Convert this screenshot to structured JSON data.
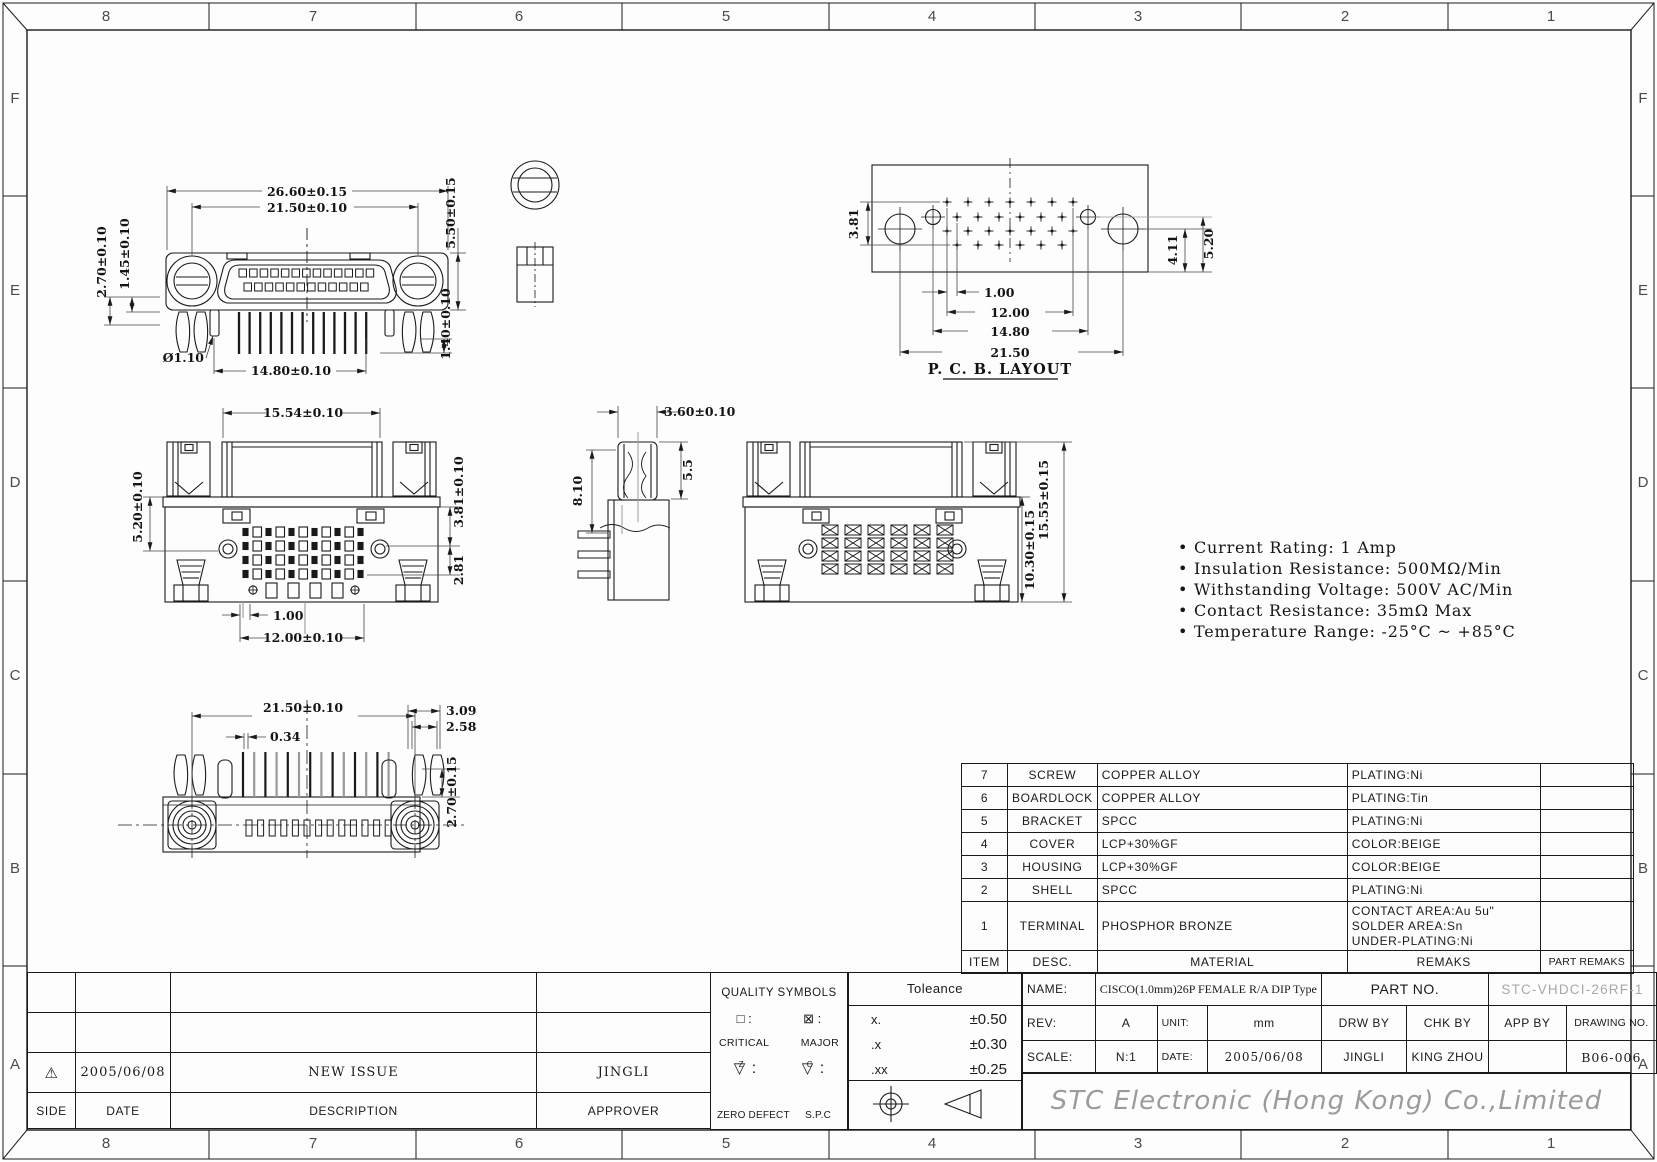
{
  "colors": {
    "ink": "#1a1a1a",
    "gray": "#9a9a9a",
    "part_no_gray": "#a8a8a8",
    "company_gray": "#9b9b9b"
  },
  "frame": {
    "cols": [
      "8",
      "7",
      "6",
      "5",
      "4",
      "3",
      "2",
      "1"
    ],
    "rows": [
      "F",
      "E",
      "D",
      "C",
      "B",
      "A"
    ]
  },
  "views": {
    "front": {
      "dim_width_outer": "26.60±0.15",
      "dim_width_inner": "21.50±0.10",
      "dim_tab": "5.50±0.15",
      "dim_left_outer": "2.70±0.10",
      "dim_left_inner": "1.45±0.10",
      "dim_pin_dia": "Ø1.10",
      "dim_pin_span": "14.80±0.10",
      "dim_pin_offset": "1.40±0.10"
    },
    "pcb": {
      "title": "P. C. B. LAYOUT",
      "dim_row": "3.81",
      "dim_pitch": "1.00",
      "dim_span1": "12.00",
      "dim_span2": "14.80",
      "dim_span3": "21.50",
      "dim_right1": "4.11",
      "dim_right2": "5.20"
    },
    "assembly_front": {
      "dim_top": "15.54±0.10",
      "dim_left": "5.20±0.10",
      "dim_right1": "3.81±0.10",
      "dim_right2": "2.81",
      "dim_pitch": "1.00",
      "dim_span": "12.00±0.10"
    },
    "side": {
      "dim_top": "3.60±0.10",
      "dim_left": "8.10",
      "dim_right": "5.5"
    },
    "assembly_rear": {
      "dim_right1": "10.30±0.15",
      "dim_right2": "15.55±0.15"
    },
    "bottom": {
      "dim_span": "21.50±0.10",
      "dim_pin": "0.34",
      "dim_r1": "3.09",
      "dim_r2": "2.58",
      "dim_height": "2.70±0.15"
    }
  },
  "notes": {
    "bullet": "•",
    "items": [
      "Current Rating: 1 Amp",
      "Insulation Resistance: 500MΩ/Min",
      "Withstanding Voltage: 500V AC/Min",
      "Contact Resistance: 35mΩ Max",
      "Temperature Range: -25°C ~ +85°C"
    ]
  },
  "parts_table": {
    "headers": {
      "item": "ITEM",
      "desc": "DESC.",
      "material": "MATERIAL",
      "remarks": "REMAKS",
      "part_remarks": "PART REMAKS"
    },
    "rows": [
      {
        "item": "7",
        "desc": "SCREW",
        "material": "COPPER ALLOY",
        "remarks": "PLATING:Ni"
      },
      {
        "item": "6",
        "desc": "BOARDLOCK",
        "material": "COPPER ALLOY",
        "remarks": "PLATING:Tin"
      },
      {
        "item": "5",
        "desc": "BRACKET",
        "material": "SPCC",
        "remarks": "PLATING:Ni"
      },
      {
        "item": "4",
        "desc": "COVER",
        "material": "LCP+30%GF",
        "remarks": "COLOR:BEIGE"
      },
      {
        "item": "3",
        "desc": "HOUSING",
        "material": "LCP+30%GF",
        "remarks": "COLOR:BEIGE"
      },
      {
        "item": "2",
        "desc": "SHELL",
        "material": "SPCC",
        "remarks": "PLATING:Ni"
      },
      {
        "item": "1",
        "desc": "TERMINAL",
        "material": "PHOSPHOR BRONZE",
        "remarks_lines": [
          "CONTACT AREA:Au 5u\"",
          "SOLDER AREA:Sn",
          "UNDER-PLATING:Ni"
        ]
      }
    ]
  },
  "revision": {
    "headers": {
      "side": "SIDE",
      "date": "DATE",
      "description": "DESCRIPTION",
      "approver": "APPROVER"
    },
    "entry": {
      "symbol": "⚠",
      "date": "2005/06/08",
      "description": "NEW ISSUE",
      "approver": "JINGLI"
    }
  },
  "quality": {
    "title": "QUALITY SYMBOLS",
    "critical_symbol": "□",
    "major_symbol": "⊠",
    "colon": ":",
    "finish_symbol": "▽",
    "zero_defect_letter": "Z",
    "spc_letter": "C",
    "critical_label": "CRITICAL",
    "major_label": "MAJOR",
    "zero_defect_label": "ZERO DEFECT",
    "spc_label": "S.P.C"
  },
  "tolerance": {
    "title": "Toleance",
    "rows": [
      {
        "label": "x.",
        "value": "±0.50"
      },
      {
        "label": ".x",
        "value": "±0.30"
      },
      {
        "label": ".xx",
        "value": "±0.25"
      }
    ]
  },
  "title_block": {
    "name_label": "NAME:",
    "name_value": "CISCO(1.0mm)26P FEMALE R/A DIP Type",
    "part_no_label": "PART NO.",
    "part_no_value": "STC-VHDCI-26RF-1",
    "rev_label": "REV:",
    "rev_value": "A",
    "unit_label": "UNIT:",
    "unit_value": "mm",
    "drw_by_label": "DRW BY",
    "drw_by_value": "JINGLI",
    "chk_by_label": "CHK BY",
    "chk_by_value": "KING ZHOU",
    "app_by_label": "APP BY",
    "app_by_value": "",
    "drawing_no_label": "DRAWING NO.",
    "drawing_no_value": "B06-006",
    "scale_label": "SCALE:",
    "scale_value": "N:1",
    "date_label": "DATE:",
    "date_value": "2005/06/08",
    "company": "STC Electronic (Hong Kong) Co.,Limited"
  }
}
